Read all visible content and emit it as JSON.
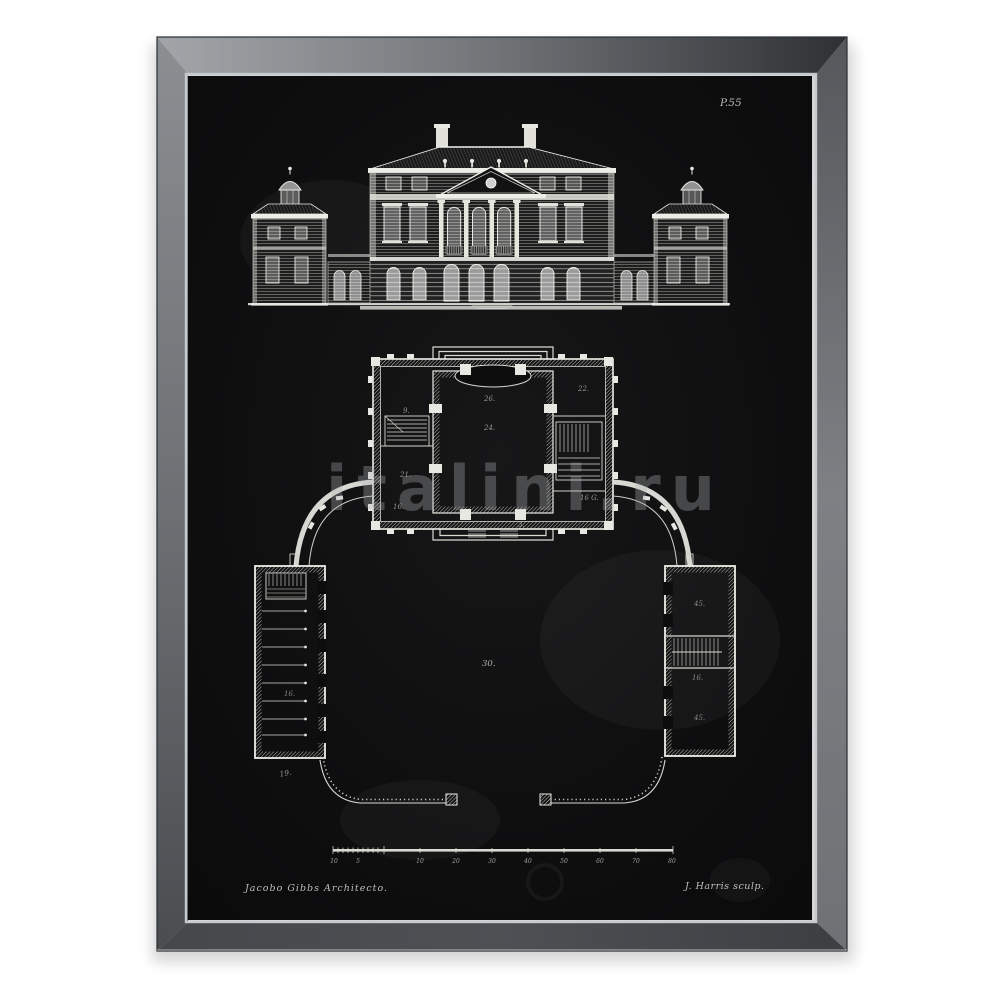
{
  "artwork": {
    "plate_number": "P.55",
    "credit_left": "Jacobo Gibbs Architecto.",
    "credit_right": "J. Harris sculp.",
    "watermark": "italini.ru",
    "scale_bar_labels": [
      "10",
      "5",
      "10",
      "20",
      "30",
      "40",
      "50",
      "60",
      "70",
      "80"
    ],
    "plan_labels": {
      "hall_upper": "26.",
      "hall_lower": "24.",
      "room_nw": "9.",
      "room_w": "21.",
      "room_sw": "16.",
      "room_ne": "22.",
      "room_e": "16 G.",
      "room_s": "3.",
      "courtyard": "30.",
      "left_wing": "16.",
      "left_wing_end": "19.",
      "right_wing_top": "45.",
      "right_wing_mid": "16.",
      "right_wing_bottom": "45."
    },
    "colors": {
      "canvas_black": "#0c0c0d",
      "ink_white": "#e8e8e2",
      "frame_gray_light": "#9fa3a6",
      "frame_gray_dark": "#3a3d40",
      "inner_lip_silver": "#c7cacc",
      "background_white": "#ffffff"
    }
  }
}
